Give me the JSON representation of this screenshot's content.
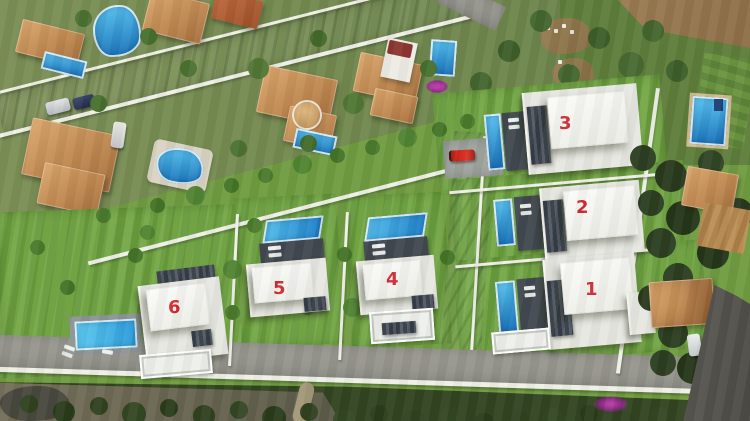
{
  "image": {
    "type": "aerial-photograph-with-cgi-render",
    "subject": "Six new white villas with pools composited into an existing residential neighborhood"
  },
  "villas": [
    {
      "number": "1"
    },
    {
      "number": "2"
    },
    {
      "number": "3"
    },
    {
      "number": "4"
    },
    {
      "number": "5"
    },
    {
      "number": "6"
    }
  ],
  "palette": {
    "number_red": "#ce2b31",
    "villa_white": "#f3f3ef",
    "pool_blue": "#1f86c8",
    "new_lawn_green": "#6f9c40",
    "existing_garden_green": "#72894e",
    "road_grey": "#93938c",
    "terracotta_roof": "#bf8850",
    "deck_charcoal": "#3e454d",
    "dark_tree_green": "#2c3e21",
    "dirt_brown": "#97774f"
  }
}
